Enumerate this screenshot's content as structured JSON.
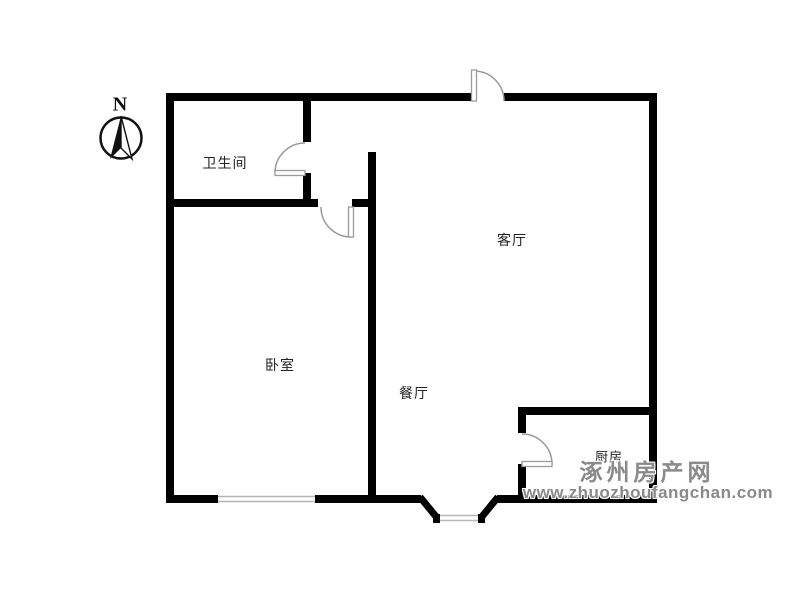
{
  "compass": {
    "north_label": "N"
  },
  "rooms": [
    {
      "name": "bathroom",
      "label": "卫生间"
    },
    {
      "name": "living-room",
      "label": "客厅"
    },
    {
      "name": "bedroom",
      "label": "卧室"
    },
    {
      "name": "dining-room",
      "label": "餐厅"
    },
    {
      "name": "kitchen",
      "label": "厨房"
    }
  ],
  "watermark": {
    "site_name": "涿州房产网",
    "site_url": "www.zhuozhoufangchan.com"
  },
  "colors": {
    "background": "#ffffff",
    "wall": "#000000",
    "door_swing": "#9a9a9a",
    "window_glass": "#b5b5b5",
    "room_label": "#222222",
    "watermark_gray": "#8a8a8a"
  }
}
